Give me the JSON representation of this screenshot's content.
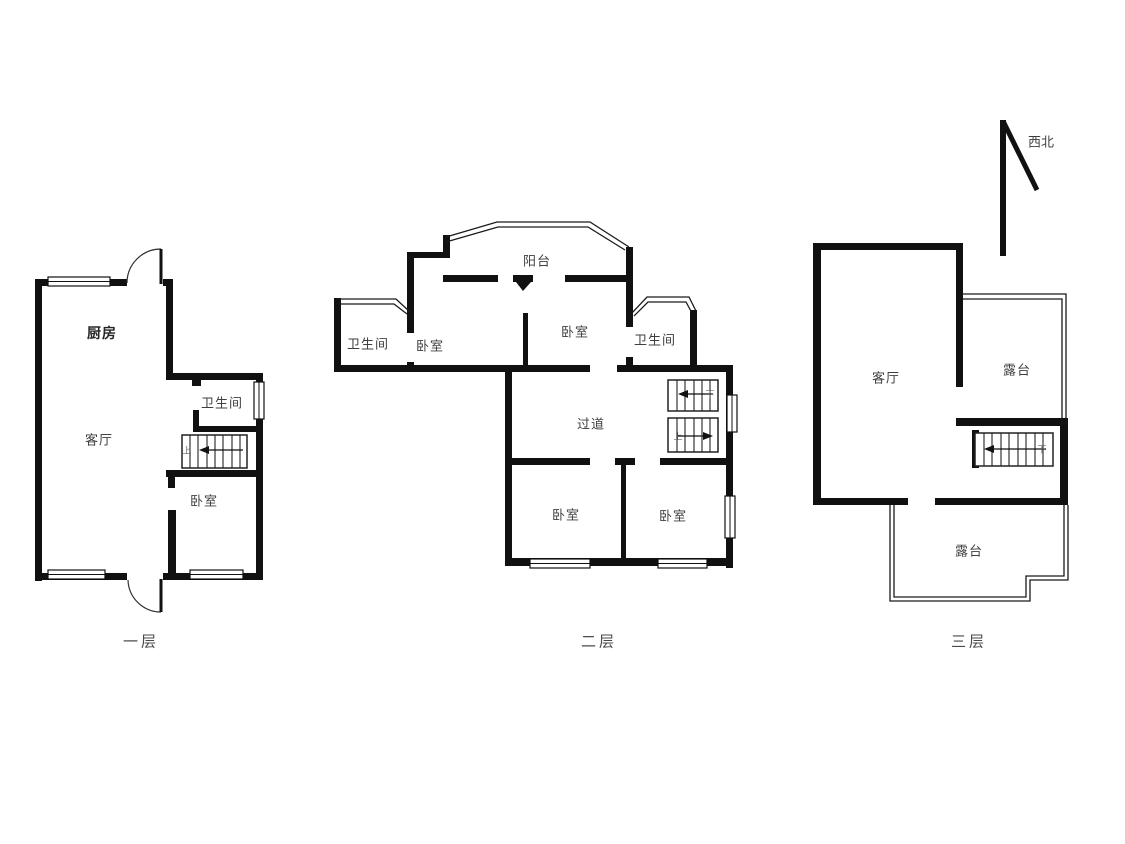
{
  "colors": {
    "wall": "#111111",
    "thin_line": "#1a1a1a",
    "label": "#3f3f3f",
    "caption": "#4a4a4a",
    "background": "#ffffff"
  },
  "compass": {
    "direction_label": "西北"
  },
  "floors": [
    {
      "caption": "一层",
      "rooms": [
        "厨房",
        "客厅",
        "卫生间",
        "卧室"
      ],
      "stair_marks": [
        "上"
      ]
    },
    {
      "caption": "二层",
      "rooms": [
        "卫生间",
        "卧室",
        "阳台",
        "卧室",
        "卫生间",
        "过道",
        "卧室",
        "卧室"
      ],
      "stair_marks": [
        "下",
        "上"
      ]
    },
    {
      "caption": "三层",
      "rooms": [
        "客厅",
        "露台",
        "露台"
      ],
      "stair_marks": [
        "下"
      ]
    }
  ]
}
